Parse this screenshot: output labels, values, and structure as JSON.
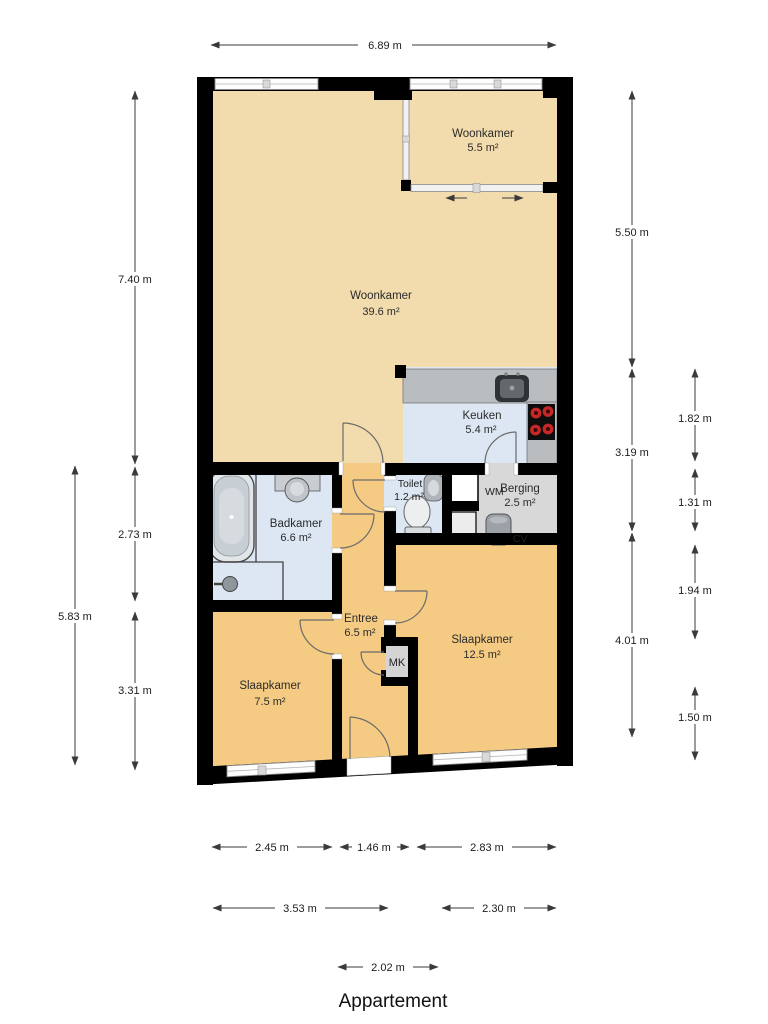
{
  "title": "Appartement",
  "rooms": {
    "serre": {
      "name": "Woonkamer",
      "area": "5.5 m²"
    },
    "living": {
      "name": "Woonkamer",
      "area": "39.6 m²"
    },
    "kitchen": {
      "name": "Keuken",
      "area": "5.4 m²"
    },
    "toilet": {
      "name": "Toilet",
      "area": "1.2 m²"
    },
    "bathroom": {
      "name": "Badkamer",
      "area": "6.6 m²"
    },
    "storage": {
      "name": "Berging",
      "area": "2.5 m²"
    },
    "hall": {
      "name": "Entree",
      "area": "6.5 m²"
    },
    "bedroom_large": {
      "name": "Slaapkamer",
      "area": "12.5 m²"
    },
    "bedroom_small": {
      "name": "Slaapkamer",
      "area": "7.5 m²"
    }
  },
  "fixtures": {
    "washing_machine": "WM",
    "boiler": "CV",
    "meter_cupboard": "MK"
  },
  "dimensions": {
    "top_width": "6.89 m",
    "left_inner": [
      "7.40 m",
      "2.73 m",
      "3.31 m"
    ],
    "left_outer": "5.83 m",
    "right_inner": [
      "5.50 m",
      "3.19 m",
      "4.01 m"
    ],
    "right_outer": [
      "1.82 m",
      "1.31 m",
      "1.94 m",
      "1.50 m"
    ],
    "bottom_row1": [
      "2.45 m",
      "1.46 m",
      "2.83 m"
    ],
    "bottom_row2": [
      "3.53 m",
      "2.30 m"
    ],
    "bottom_row3": "2.02 m"
  },
  "colors": {
    "wall": "#000000",
    "floor_living": "#F2DBAC",
    "floor_bedroom": "#F5CB84",
    "floor_wet": "#DCE7F3",
    "floor_storage": "#D8D8D8",
    "counter": "#B9BDC0",
    "burner": "#C62828"
  }
}
